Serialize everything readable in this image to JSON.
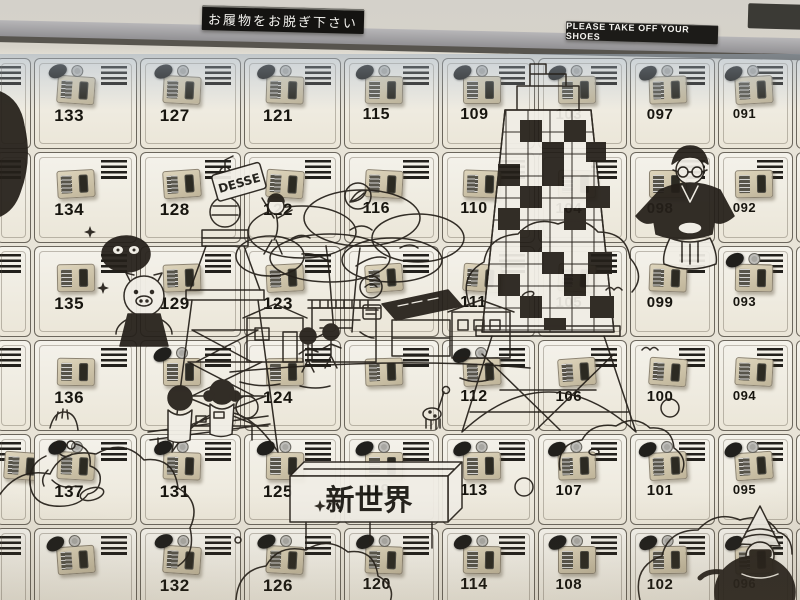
{
  "signs": {
    "japanese_sign": "お履物をお脱ぎ下さい",
    "english_sign": "PLEASE TAKE OFF YOUR SHOES"
  },
  "mural": {
    "banner_text": "新世界",
    "tag_text": "DESSE",
    "elements": [
      "tsutenkaku-tower",
      "checkered-tower",
      "big-tree",
      "street-houses",
      "clouds",
      "kimono-man",
      "hooded-man",
      "billiken",
      "children-at-counter",
      "walking-kids",
      "pig-cook",
      "masked-animal",
      "woman-long-hair",
      "giraffe",
      "leaf-stamp",
      "sparkles"
    ]
  },
  "lockers": {
    "columns": [
      {
        "name": "left-partial",
        "cells": [
          {
            "number": "",
            "key": false,
            "plate": false
          },
          {
            "number": "",
            "key": false,
            "plate": false
          },
          {
            "number": "",
            "key": false,
            "plate": false
          },
          {
            "number": "",
            "key": false,
            "plate": false
          },
          {
            "number": "",
            "key": false,
            "plate": true
          },
          {
            "number": "",
            "key": false,
            "plate": false
          }
        ]
      },
      {
        "name": "column-133",
        "cells": [
          {
            "number": "133",
            "key": true
          },
          {
            "number": "134",
            "key": false
          },
          {
            "number": "135",
            "key": false
          },
          {
            "number": "136",
            "key": false
          },
          {
            "number": "137",
            "key": true
          },
          {
            "number": "",
            "key": true
          }
        ]
      },
      {
        "name": "column-127",
        "cells": [
          {
            "number": "127",
            "key": true
          },
          {
            "number": "128",
            "key": false
          },
          {
            "number": "129",
            "key": false
          },
          {
            "number": "",
            "key": true
          },
          {
            "number": "131",
            "key": true
          },
          {
            "number": "132",
            "key": true
          }
        ]
      },
      {
        "name": "column-121",
        "cells": [
          {
            "number": "121",
            "key": true
          },
          {
            "number": "122",
            "key": false
          },
          {
            "number": "123",
            "key": false
          },
          {
            "number": "124",
            "key": false
          },
          {
            "number": "125",
            "key": true
          },
          {
            "number": "126",
            "key": true
          }
        ]
      },
      {
        "name": "column-115",
        "cells": [
          {
            "number": "115",
            "key": true
          },
          {
            "number": "116",
            "key": false
          },
          {
            "number": "",
            "key": false
          },
          {
            "number": "",
            "key": false
          },
          {
            "number": "119",
            "key": true
          },
          {
            "number": "120",
            "key": true
          }
        ]
      },
      {
        "name": "column-109",
        "cells": [
          {
            "number": "109",
            "key": true
          },
          {
            "number": "110",
            "key": false
          },
          {
            "number": "111",
            "key": false
          },
          {
            "number": "112",
            "key": true
          },
          {
            "number": "113",
            "key": true
          },
          {
            "number": "114",
            "key": true
          }
        ]
      },
      {
        "name": "column-103",
        "cells": [
          {
            "number": "103",
            "key": true
          },
          {
            "number": "104",
            "key": false
          },
          {
            "number": "105",
            "key": false
          },
          {
            "number": "106",
            "key": false
          },
          {
            "number": "107",
            "key": true
          },
          {
            "number": "108",
            "key": true
          }
        ]
      },
      {
        "name": "column-097",
        "cells": [
          {
            "number": "097",
            "key": true
          },
          {
            "number": "098",
            "key": false
          },
          {
            "number": "099",
            "key": false
          },
          {
            "number": "100",
            "key": false
          },
          {
            "number": "101",
            "key": true
          },
          {
            "number": "102",
            "key": true
          }
        ]
      },
      {
        "name": "column-091",
        "cells": [
          {
            "number": "091",
            "key": true
          },
          {
            "number": "092",
            "key": false
          },
          {
            "number": "093",
            "key": true
          },
          {
            "number": "094",
            "key": false
          },
          {
            "number": "095",
            "key": true
          },
          {
            "number": "096",
            "key": true
          }
        ]
      },
      {
        "name": "right-partial",
        "cells": [
          {
            "number": "",
            "key": false,
            "plate": false
          },
          {
            "number": "",
            "key": false,
            "plate": true
          },
          {
            "number": "",
            "key": false,
            "plate": false
          },
          {
            "number": "",
            "key": false,
            "plate": true
          },
          {
            "number": "",
            "key": false,
            "plate": false
          },
          {
            "number": "090",
            "key": false,
            "plate": true
          }
        ]
      }
    ]
  },
  "colors": {
    "locker_body": "#f0ede3",
    "frame": "#6b665c",
    "plate": "#cfc5ab",
    "ink": "#241f19",
    "sign_bg": "#141311",
    "sign_text": "#f4f3ef",
    "rail": "#98979a",
    "top_tint": "#a3b2c2"
  }
}
